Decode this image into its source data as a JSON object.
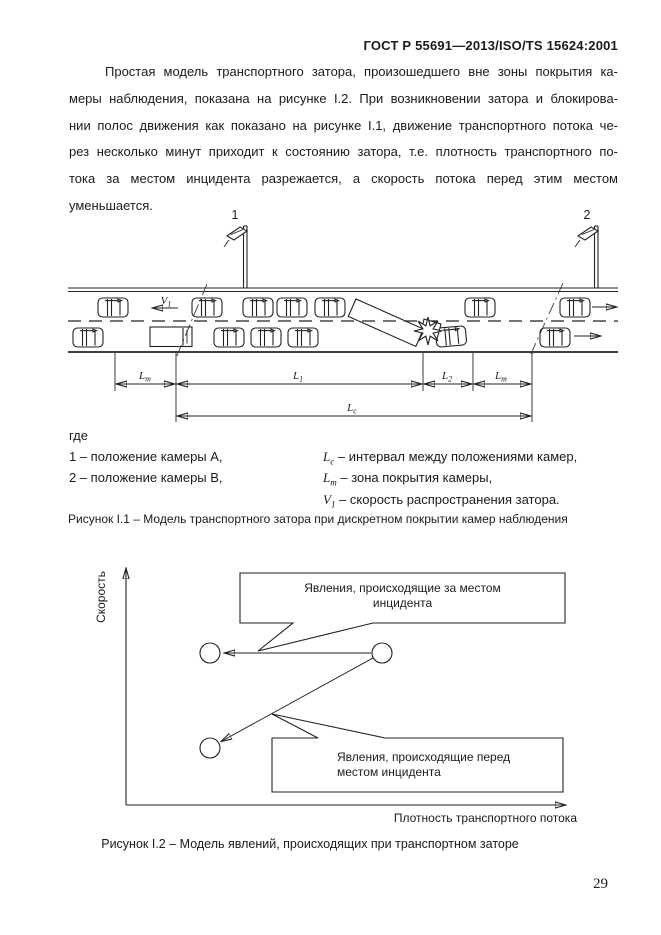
{
  "header": {
    "text": "ГОСТ Р 55691—2013/ISO/TS 15624:2001"
  },
  "paragraph": {
    "lines": [
      "Простая модель транспортного затора, произошедшего вне зоны покрытия ка-",
      "меры наблюдения, показана на рисунке I.2. При возникновении затора и блокирова-",
      "нии полос движения как показано на рисунке I.1, движение транспортного потока че-",
      "рез несколько минут приходит к состоянию затора, т.е. плотность транспортного по-",
      "тока за местом инцидента разрежается, а скорость потока перед этим местом",
      "уменьшается."
    ]
  },
  "figure1": {
    "camera1_label": "1",
    "camera2_label": "2",
    "v1": {
      "main": "V",
      "sub": "1"
    },
    "dims": {
      "lm_left": {
        "main": "L",
        "sub": "m"
      },
      "l1": {
        "main": "L",
        "sub": "1"
      },
      "l2": {
        "main": "L",
        "sub": "2"
      },
      "lm_right": {
        "main": "L",
        "sub": "m"
      },
      "lc": {
        "main": "L",
        "sub": "c"
      }
    },
    "legend": {
      "where": "где",
      "left": [
        {
          "text": "1 – положение камеры А,"
        },
        {
          "text": "2 – положение камеры В,"
        }
      ],
      "right": [
        {
          "sym_main": "L",
          "sym_sub": "c",
          "text": " – интервал между положениями камер,"
        },
        {
          "sym_main": "L",
          "sym_sub": "m",
          "text": " – зона покрытия камеры,"
        },
        {
          "sym_main": "V",
          "sym_sub": "1",
          "text": " – скорость распространения затора."
        }
      ]
    },
    "caption": "Рисунок I.1 – Модель транспортного затора при дискретном покрытии камер наблюдения"
  },
  "figure2": {
    "y_axis_label": "Скорость",
    "x_axis_label": "Плотность транспортного потока",
    "callout_top": {
      "line1": "Явления, происходящие за местом",
      "line2": "инцидента"
    },
    "callout_bottom": {
      "line1": "Явления, происходящие перед",
      "line2": "местом инцидента"
    },
    "caption": "Рисунок I.2 – Модель явлений, происходящих при транспортном заторе"
  },
  "page": {
    "number": "29"
  }
}
